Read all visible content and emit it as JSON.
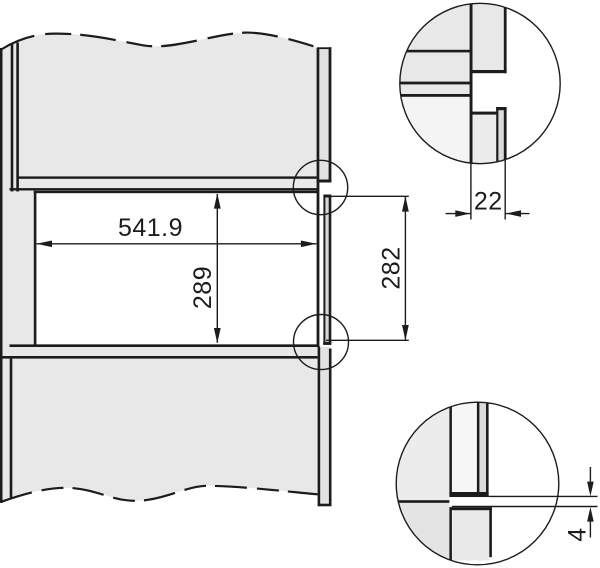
{
  "figure": {
    "kind": "built-in appliance niche dimension drawing",
    "dimensions": {
      "niche_width": "541.9",
      "niche_inner_height": "289",
      "front_frame_height": "282",
      "side_panel_thickness": "22",
      "bottom_gap": "4"
    },
    "colors": {
      "line": "#1c1c1c",
      "panel": "#e8e8e8",
      "panel_light": "#f4f4f4",
      "panel_mid": "#ececec",
      "strip": "#e2e2e2",
      "strip_dark": "#d8d8d8",
      "strip_n": "#dadada",
      "near_white": "#f6f6f6",
      "wedge": "#e4e4e4"
    }
  }
}
